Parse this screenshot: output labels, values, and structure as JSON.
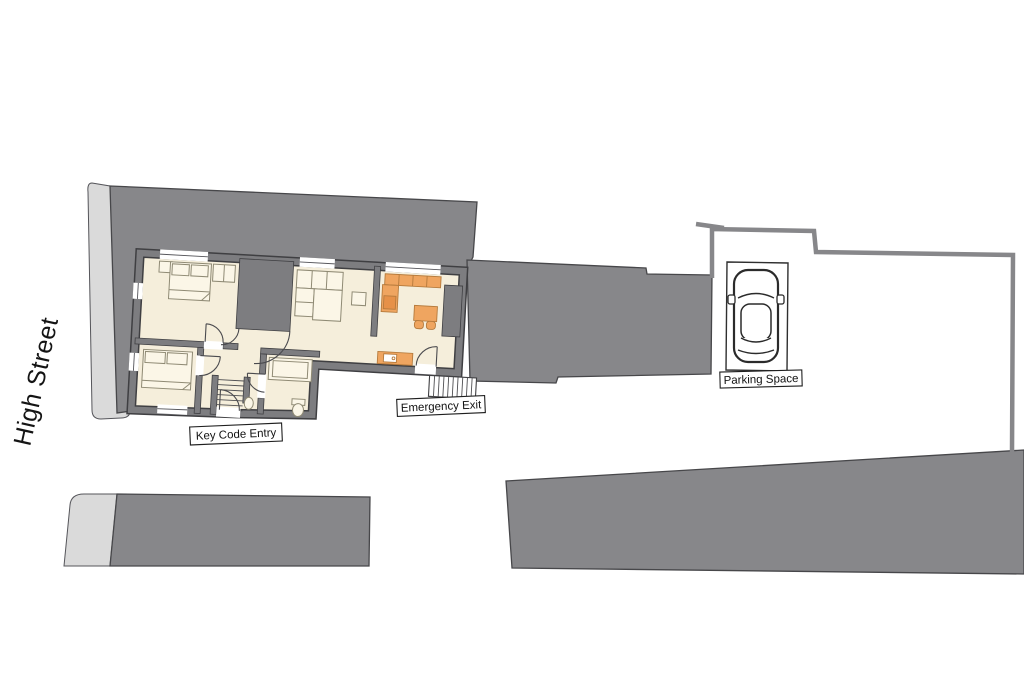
{
  "labels": {
    "street": "High Street",
    "key_code_entry": "Key Code Entry",
    "emergency_exit": "Emergency Exit",
    "parking_space": "Parking Space"
  },
  "colors": {
    "background": "#ffffff",
    "building_mass": "#87878a",
    "apartment_wall": "#7d7d80",
    "wall_edge": "#3f3f42",
    "floor": "#f5eedb",
    "pavement": "#dadada",
    "kitchen_units": "#efa560",
    "furniture_outline": "#8f8a74",
    "label_text": "#111111"
  },
  "areas": [
    "double-bedroom-top-left",
    "double-bedroom-bottom-left",
    "lounge-bedroom-centre",
    "kitchen-diner",
    "bathroom",
    "hallway",
    "internal-staircase",
    "external-emergency-staircase",
    "parking-space-with-car",
    "neighbouring-building-mass",
    "pavement"
  ]
}
